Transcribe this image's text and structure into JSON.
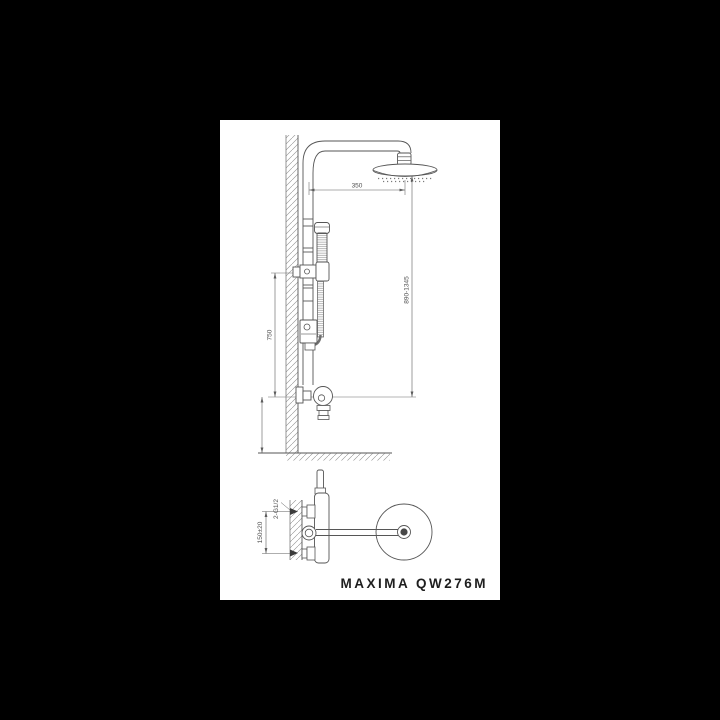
{
  "sheet": {
    "background": "#ffffff",
    "window_background": "#000000",
    "line_color": "#565656",
    "dim_color": "#5c5c5c"
  },
  "drawing": {
    "type": "technical-installation-diagram",
    "views": [
      "front-elevation-shower-column",
      "top-plan-mixer-and-rain-head"
    ],
    "labels": {
      "head_offset": "350",
      "column_height_range": "890-1345",
      "slidebar_to_mixer": "750",
      "mixer_mount_height": "900-1000",
      "inlet_spacing": "150±20",
      "inlet_connection": "2-G1/2"
    }
  },
  "footer": {
    "model": "MAXIMA QW276M"
  }
}
